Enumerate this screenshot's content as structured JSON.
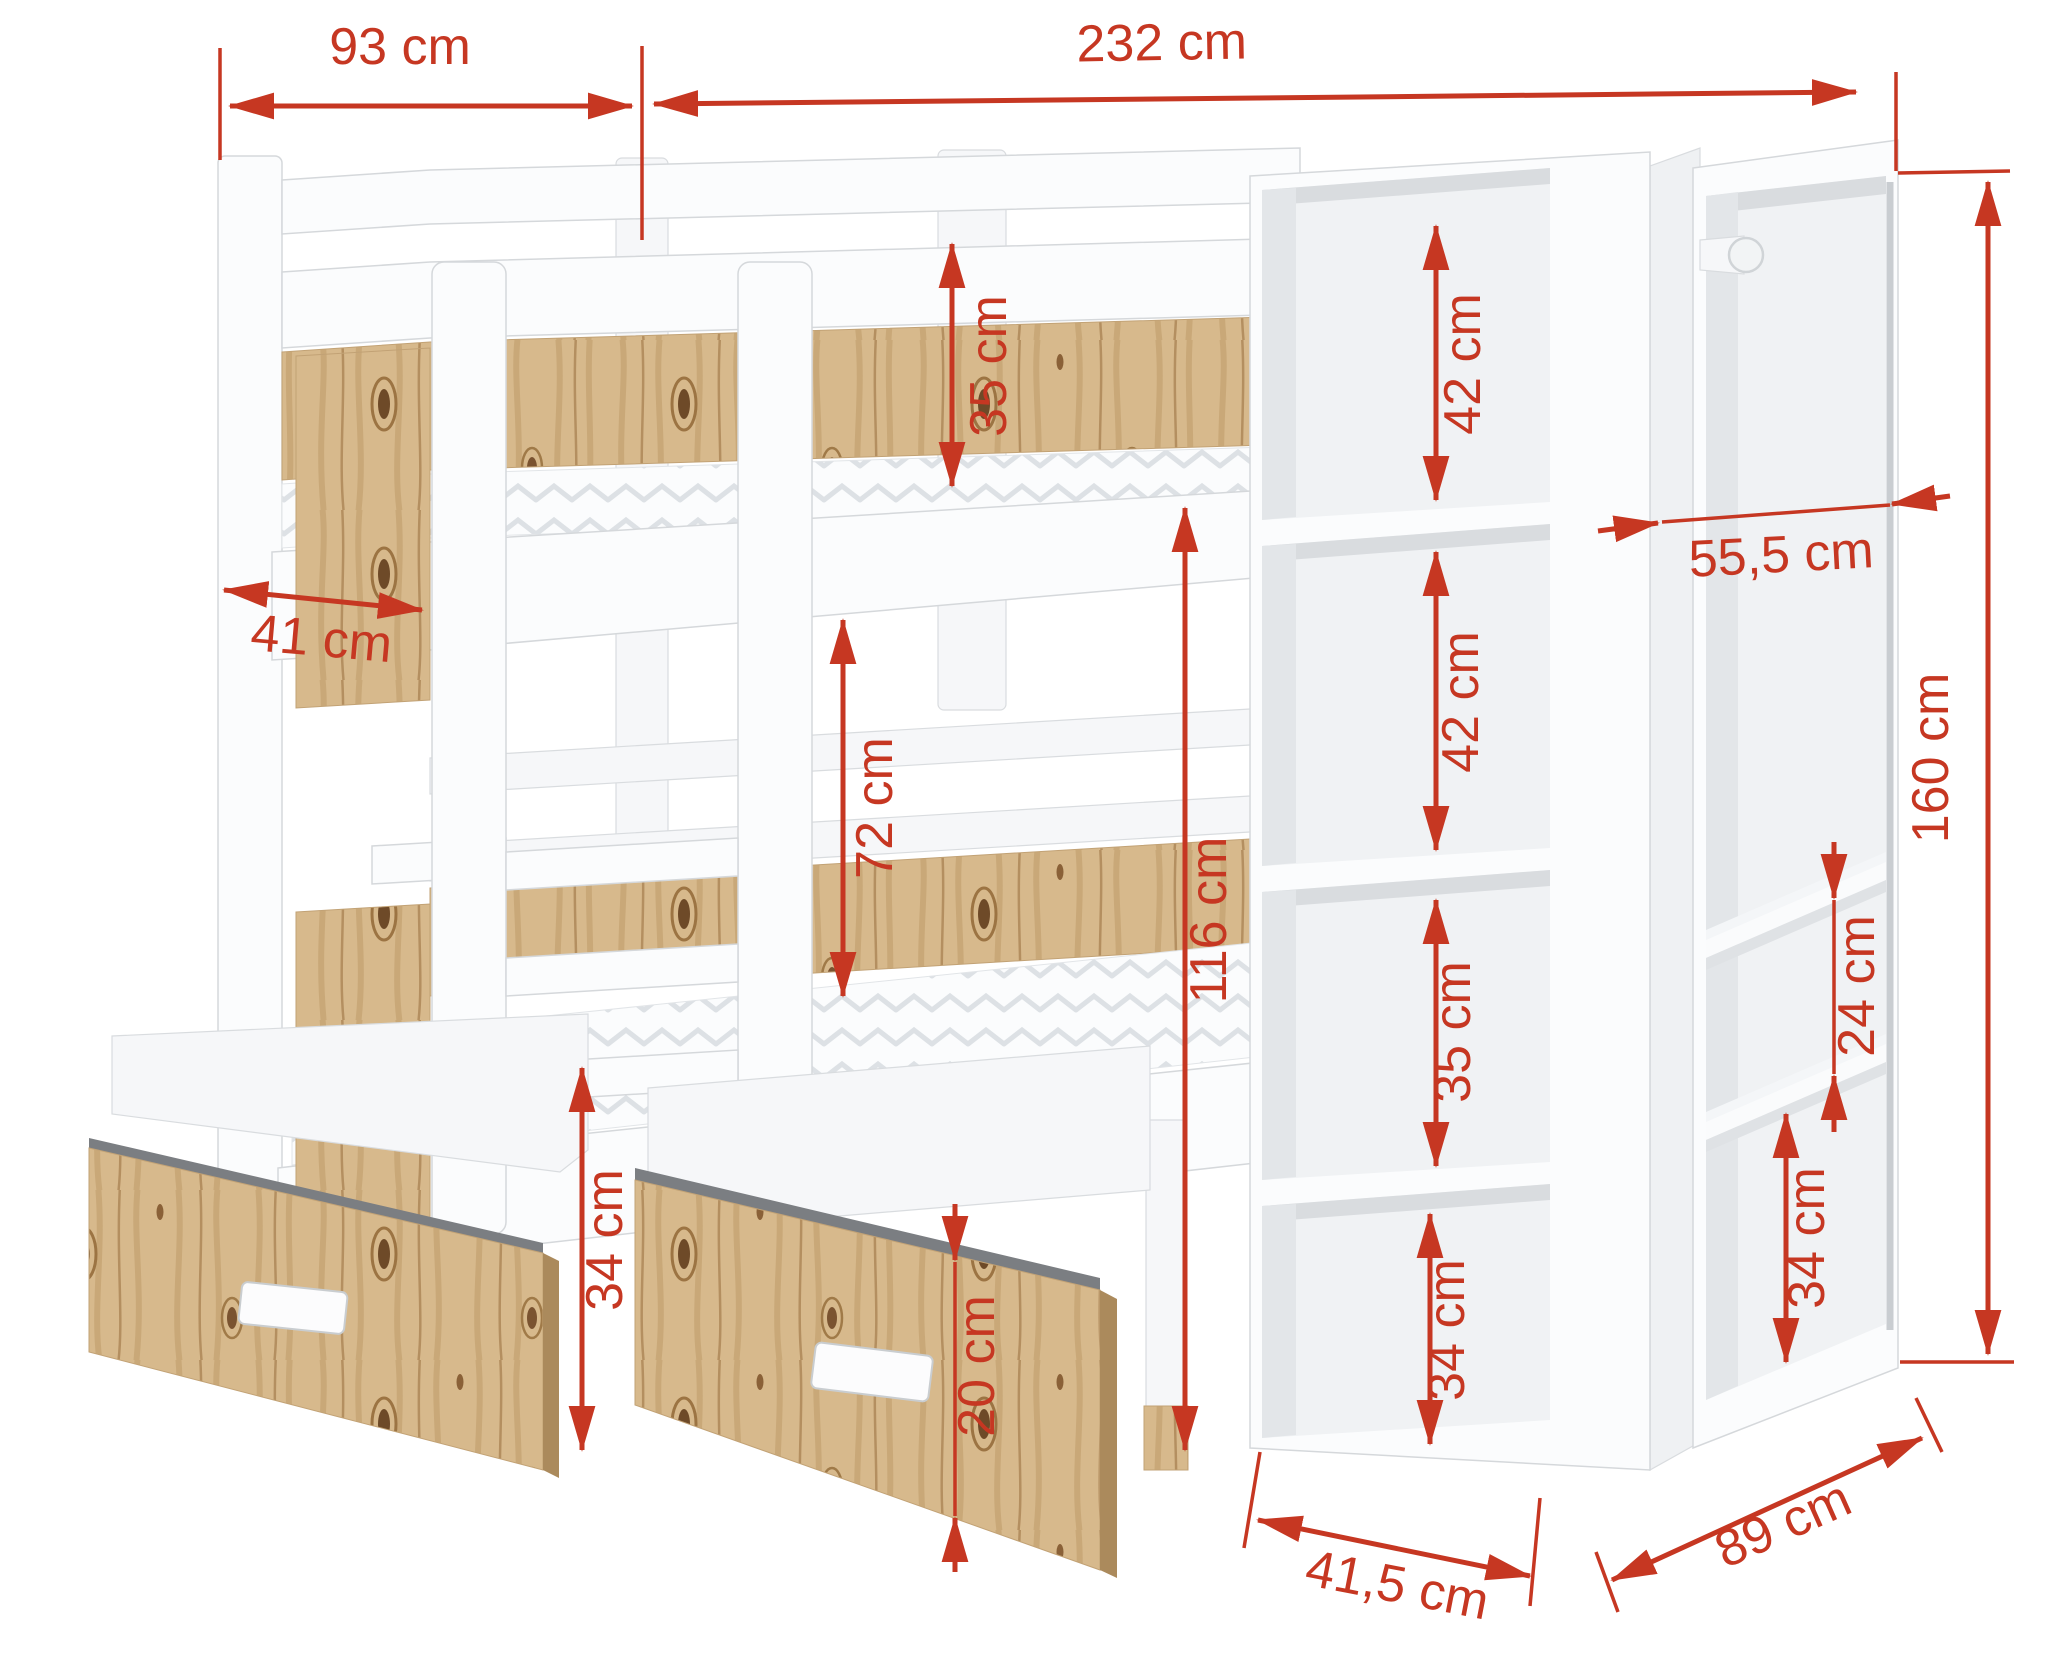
{
  "unit": "cm",
  "colors": {
    "dimension_red": "#c63722",
    "wood_light": "#d7b98c",
    "wood_grain": "#b8925f",
    "wood_dark": "#6e4a28",
    "furniture_white": "#fbfcfd",
    "panel_shadow": "#e9ebee",
    "mattress_pattern": "#dde1e5"
  },
  "dimensions": [
    {
      "id": "bed-end-width",
      "label": "93 cm"
    },
    {
      "id": "overall-width",
      "label": "232 cm"
    },
    {
      "id": "guard-rail-height",
      "label": "35 cm"
    },
    {
      "id": "footboard-width",
      "label": "41 cm"
    },
    {
      "id": "shelf-opening-top",
      "label": "42 cm"
    },
    {
      "id": "wardrobe-depth",
      "label": "55,5 cm"
    },
    {
      "id": "shelf-opening-second",
      "label": "42 cm"
    },
    {
      "id": "bunk-clearance",
      "label": "72 cm"
    },
    {
      "id": "top-bunk-height",
      "label": "116 cm"
    },
    {
      "id": "shelf-opening-third",
      "label": "35 cm"
    },
    {
      "id": "total-height",
      "label": "160 cm"
    },
    {
      "id": "wardrobe-shelf-gap",
      "label": "24 cm"
    },
    {
      "id": "shelf-opening-bottom",
      "label": "34 cm"
    },
    {
      "id": "wardrobe-bottom-opening",
      "label": "34 cm"
    },
    {
      "id": "drawer-box-height",
      "label": "34 cm"
    },
    {
      "id": "drawer-front-height",
      "label": "20 cm"
    },
    {
      "id": "shelf-unit-depth",
      "label": "41,5 cm"
    },
    {
      "id": "wardrobe-width",
      "label": "89 cm"
    }
  ]
}
